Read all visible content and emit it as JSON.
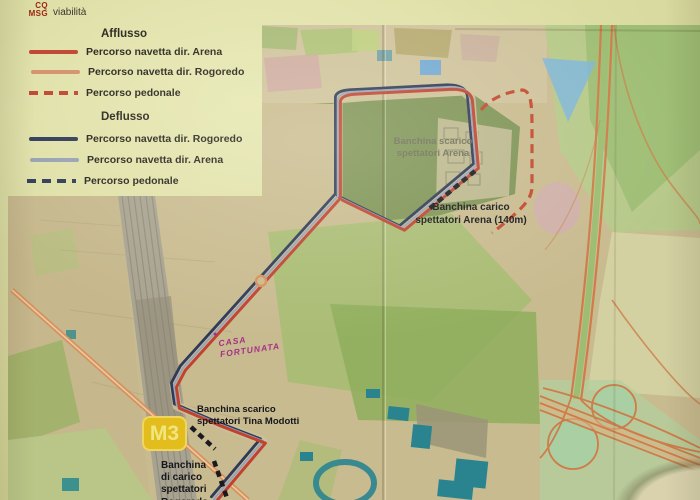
{
  "header": {
    "logo_line1": "CQ",
    "logo_line2": "MSG",
    "title": "viabilità"
  },
  "legend": {
    "afflusso_heading": "Afflusso",
    "deflusso_heading": "Deflusso",
    "afflusso_items": [
      {
        "label": "Percorso navetta dir. Arena",
        "style": "solid",
        "color": "#bf4330"
      },
      {
        "label": "Percorso navetta dir. Rogoredo",
        "style": "solid",
        "color": "#d4906c"
      },
      {
        "label": "Percorso pedonale",
        "style": "dashed",
        "color": "#bf4330"
      }
    ],
    "deflusso_items": [
      {
        "label": "Percorso navetta dir. Rogoredo",
        "style": "solid",
        "color": "#2e3a57"
      },
      {
        "label": "Percorso navetta dir. Arena",
        "style": "solid",
        "color": "#97a0b4"
      },
      {
        "label": "Percorso pedonale",
        "style": "dashed",
        "color": "#2e3a57"
      }
    ]
  },
  "map": {
    "labels": {
      "arena_scarico": "Banchina scarico\nspettatori Arena",
      "arena_carico": "Banchina carico\nspettatori Arena (140m)",
      "tina_modotti": "Banchina scarico\nspettatori Tina Modotti",
      "rogoredo_carico": "Banchina\ndi carico\nspettatori\nRogoredo",
      "casa_note": "CASA\nFORTUNATA",
      "casa_dot": "●",
      "metro_badge": "M3"
    }
  },
  "colors": {
    "route_red": "#bf4330",
    "route_salmon": "#d4906c",
    "route_navy": "#2e3a57",
    "route_slate": "#9aa3b6",
    "dash_red": "#c2492f",
    "dock_black": "#1a1a1e",
    "metro_yellow": "#e3bd1e",
    "metro_text": "#f0e67f",
    "casa_magenta": "#a82f88",
    "map_tan": "#c9bb90",
    "rail_gray": "#a8a391",
    "highway_orange": "#cf7c49",
    "road_orange": "#d6915c",
    "teal": "#2a8490",
    "pond_blue": "#7fb6d9",
    "pink_circle": "#d2abb6",
    "green_light": "#b9c687",
    "green_mid": "#9cb166"
  }
}
